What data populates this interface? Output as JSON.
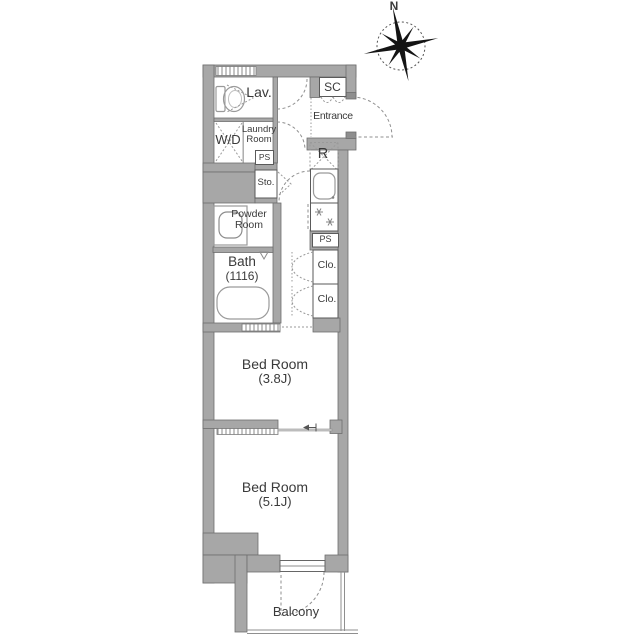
{
  "compass": {
    "north": "N"
  },
  "rooms": {
    "lav": {
      "label": "Lav."
    },
    "wd": {
      "label": "W/D"
    },
    "laundry": {
      "line1": "Laundry",
      "line2": "Room"
    },
    "ps_top": {
      "label": "PS"
    },
    "sc": {
      "label": "SC"
    },
    "entrance": {
      "label": "Entrance"
    },
    "refrigerator": {
      "label": "R"
    },
    "storage": {
      "label": "Sto."
    },
    "powder": {
      "line1": "Powder",
      "line2": "Room"
    },
    "bath": {
      "line1": "Bath",
      "line2": "(1116)"
    },
    "ps_kitchen": {
      "label": "PS"
    },
    "closet_upper": {
      "label": "Clo."
    },
    "closet_lower": {
      "label": "Clo."
    },
    "bedroom_upper": {
      "line1": "Bed Room",
      "line2": "(3.8J)"
    },
    "bedroom_lower": {
      "line1": "Bed Room",
      "line2": "(5.1J)"
    },
    "balcony": {
      "label": "Balcony"
    }
  },
  "colors": {
    "wall": "#a7a7a7",
    "wall_edge": "#6f6f6f",
    "text": "#3a3a3a",
    "fixture_outline": "#9a9a9a",
    "dashed_lines": "#8f8f8f",
    "background": "#ffffff"
  }
}
